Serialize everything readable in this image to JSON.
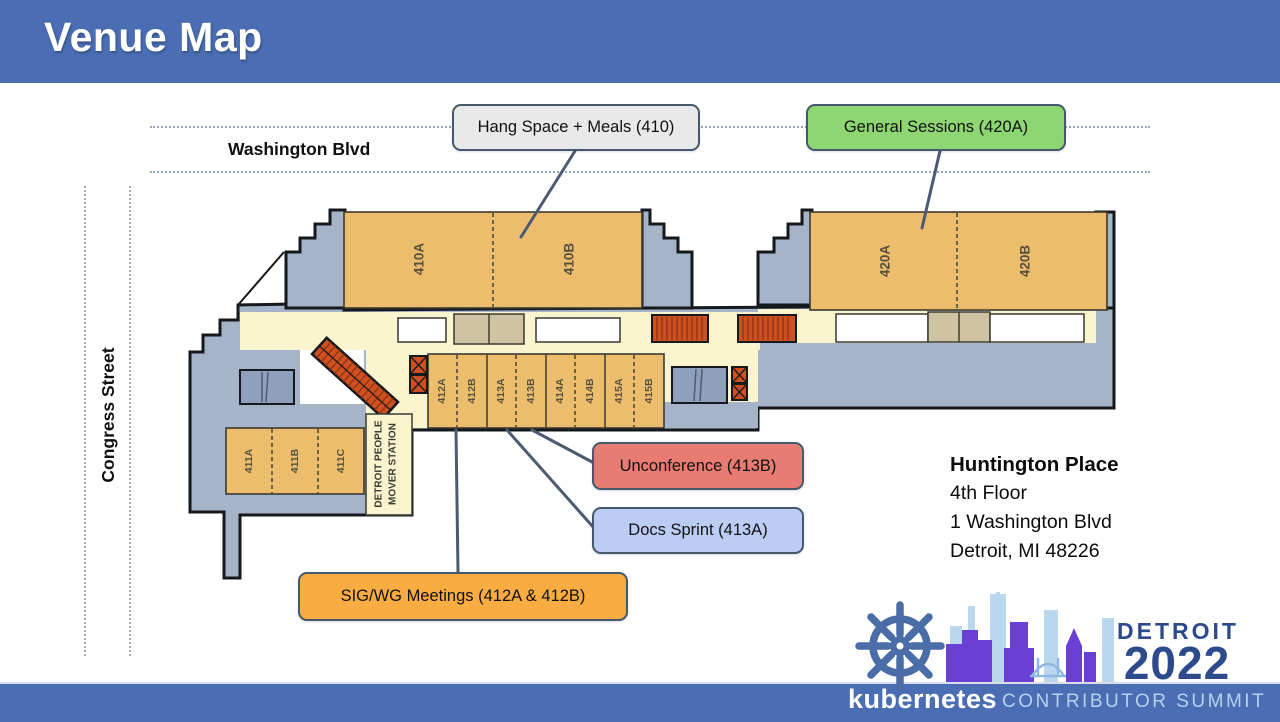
{
  "slide": {
    "title": "Venue Map"
  },
  "streets": {
    "top": "Washington Blvd",
    "left": "Congress Street"
  },
  "callouts": {
    "hang_space": {
      "label": "Hang Space + Meals (410)",
      "color": "#e9e9e9"
    },
    "general_sessions": {
      "label": "General Sessions (420A)",
      "color": "#8dd671"
    },
    "unconference": {
      "label": "Unconference (413B)",
      "color": "#e87b72"
    },
    "docs_sprint": {
      "label": "Docs Sprint (413A)",
      "color": "#bccdf4"
    },
    "sig_wg": {
      "label": "SIG/WG Meetings (412A & 412B)",
      "color": "#f9ac42"
    }
  },
  "rooms": {
    "r410a": "410A",
    "r410b": "410B",
    "r420a": "420A",
    "r420b": "420B",
    "r411a": "411A",
    "r411b": "411B",
    "r411c": "411C",
    "r412a": "412A",
    "r412b": "412B",
    "r413a": "413A",
    "r413b": "413B",
    "r414a": "414A",
    "r414b": "414B",
    "r415a": "415A",
    "r415b": "415B"
  },
  "station": {
    "line1": "DETROIT PEOPLE",
    "line2": "MOVER STATION"
  },
  "venue": {
    "name": "Huntington Place",
    "floor": "4th Floor",
    "street": "1 Washington Blvd",
    "city": "Detroit, MI 48226"
  },
  "logo": {
    "city": "DETROIT",
    "year": "2022",
    "brand": "kubernetes",
    "event": "CONTRIBUTOR SUMMIT"
  },
  "colors": {
    "header_bar": "#4a6db3",
    "room_fill": "#edbd6e",
    "corridor": "#faf4cf",
    "building_mass": "#a6b4ca",
    "escalator_red": "#cd5020",
    "leader_line": "#4a5b72",
    "logo_blue": "#4a6da8",
    "logo_navy": "#2d4b8c"
  }
}
